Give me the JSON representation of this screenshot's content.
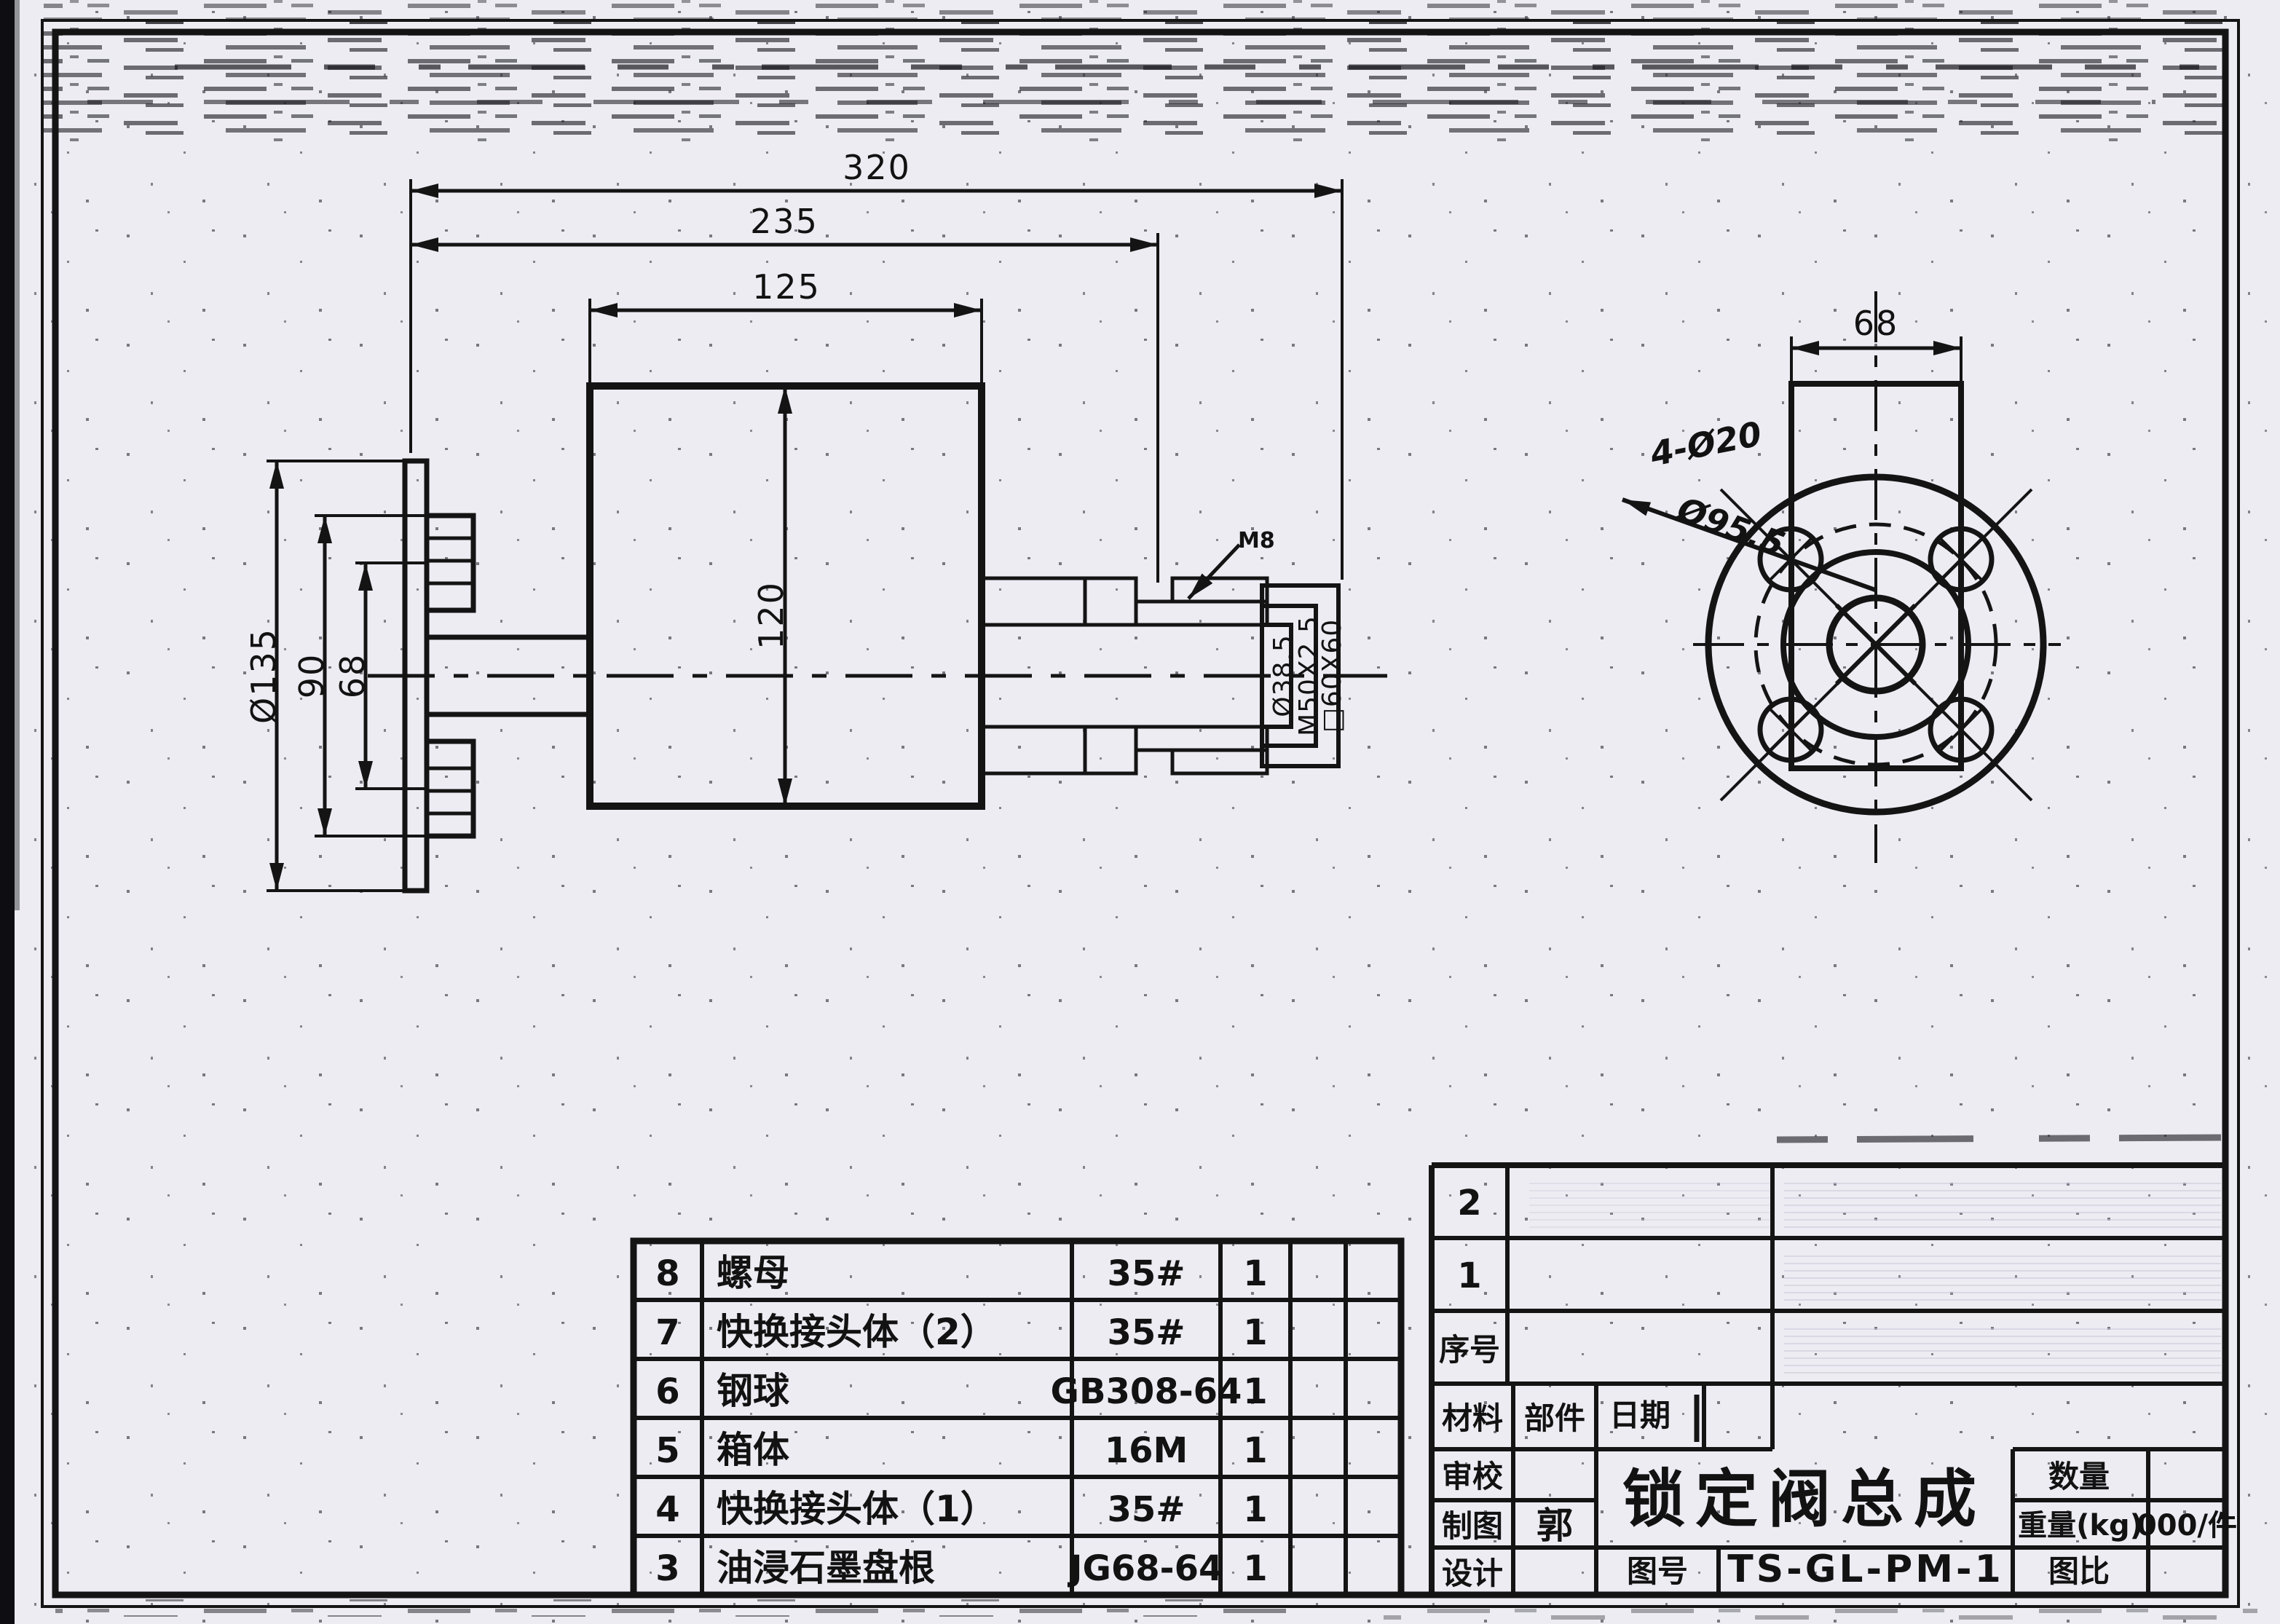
{
  "sheet": {
    "kind": "scanned engineering drawing",
    "paper_color": "#edecf3",
    "line_color": "#141414"
  },
  "front_view": {
    "dims": {
      "overall_length": "320",
      "length_to_thread_end": "235",
      "body_length": "125",
      "body_height": "120",
      "flange_diameter": "Ø135",
      "flange_boss_span": "90",
      "bolt_spacing": "68",
      "bore_diameter": "Ø38.5",
      "thread_spec": "M50X2.5",
      "square_end": "□60X60",
      "screw_leader": "M8"
    }
  },
  "end_view": {
    "dims": {
      "body_width": "68",
      "bolt_holes": "4-Ø20",
      "bolt_circle": "Ø95.5"
    }
  },
  "parts_table": {
    "rows": [
      {
        "no": "8",
        "name": "螺母",
        "spec": "35#",
        "qty": "1"
      },
      {
        "no": "7",
        "name": "快换接头体（2）",
        "spec": "35#",
        "qty": "1"
      },
      {
        "no": "6",
        "name": "钢球",
        "spec": "GB308-64",
        "qty": "1"
      },
      {
        "no": "5",
        "name": "箱体",
        "spec": "16M",
        "qty": "1"
      },
      {
        "no": "4",
        "name": "快换接头体（1）",
        "spec": "35#",
        "qty": "1"
      },
      {
        "no": "3",
        "name": "油浸石墨盘根",
        "spec": "JG68-64",
        "qty": "1"
      }
    ]
  },
  "title_block": {
    "row_2": "2",
    "row_1": "1",
    "seq_label": "序号",
    "material_label": "材料",
    "part_label": "部件",
    "date_label": "日期",
    "review_label": "审校",
    "draft_label": "制图",
    "draft_value": "郭",
    "design_label": "设计",
    "title": "锁定阀总成",
    "qty_label": "数量",
    "weight_label": "重量(kg)",
    "weight_value": "000/件",
    "dwg_no_label": "图号",
    "dwg_no_value": "TS-GL-PM-1",
    "scale_label": "图比"
  }
}
